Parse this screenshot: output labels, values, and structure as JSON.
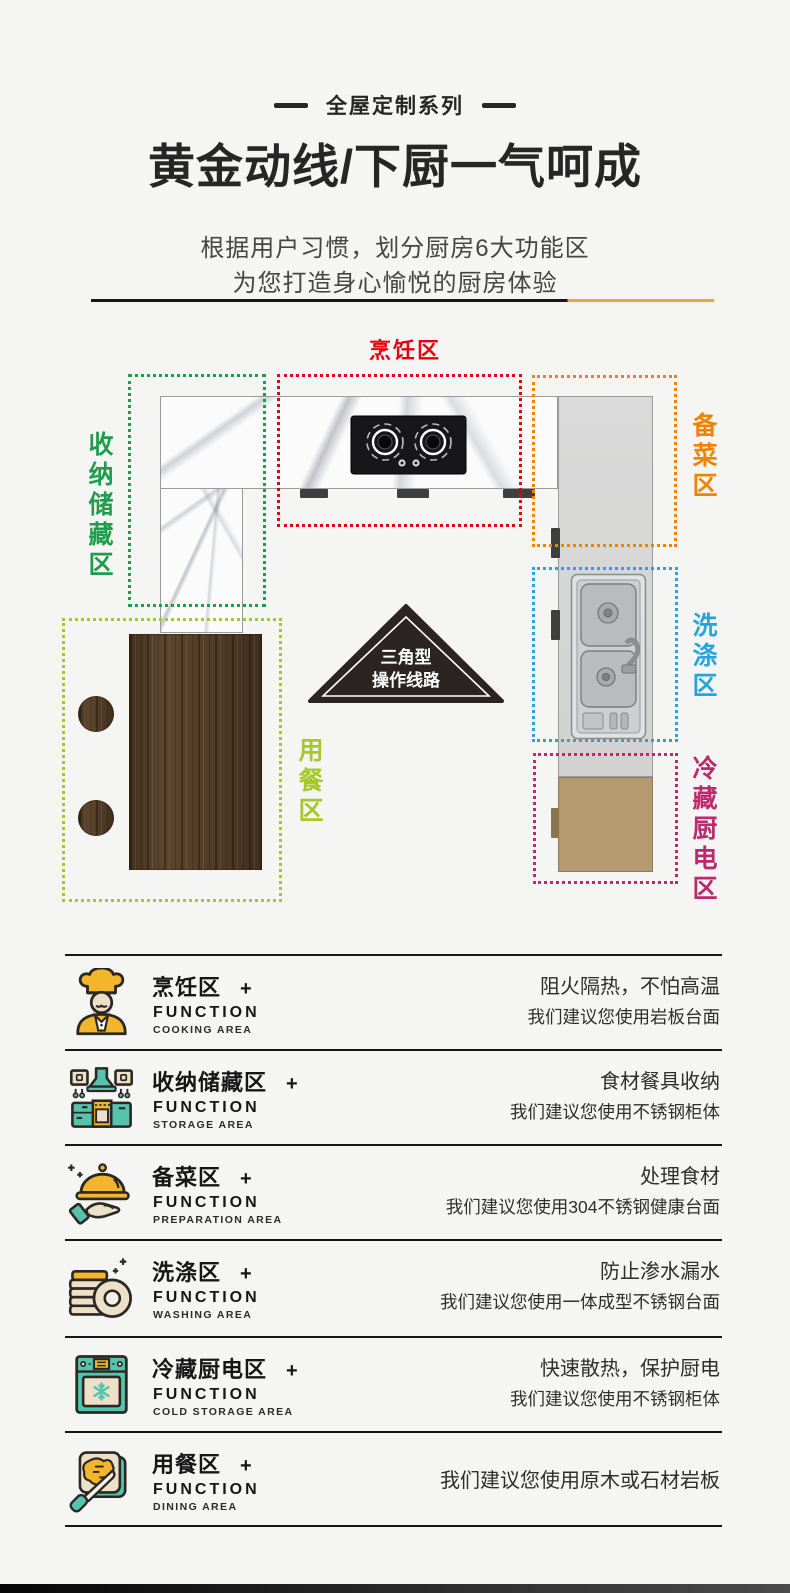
{
  "window": {
    "width": 790,
    "height": 1593,
    "background": "#f5f5f3"
  },
  "header": {
    "series_label": "全屋定制系列",
    "title": "黄金动线/下厨一气呵成",
    "subtitle_line1": "根据用户习惯，划分厨房6大功能区",
    "subtitle_line2": "为您打造身心愉悦的厨房体验"
  },
  "colors": {
    "accent_orange": "#f0a23f",
    "zone_cooking": "#e60012",
    "zone_storage": "#1f9d4d",
    "zone_preparation": "#f08300",
    "zone_washing": "#29a3dd",
    "zone_cold_storage": "#bb2a6c",
    "zone_dining": "#a6c82e",
    "icon_yellow": "#f2b52b",
    "icon_teal": "#56c3ad",
    "icon_cream": "#ece0c8"
  },
  "floor_plan": {
    "zones": [
      {
        "id": "cooking",
        "label": "烹饪区",
        "color": "#e60012"
      },
      {
        "id": "storage",
        "label": "收纳储藏区",
        "color": "#1f9d4d"
      },
      {
        "id": "preparation",
        "label": "备菜区",
        "color": "#f08300"
      },
      {
        "id": "washing",
        "label": "洗涤区",
        "color": "#29a3dd"
      },
      {
        "id": "cold_storage",
        "label": "冷藏厨电区",
        "color": "#bb2a6c"
      },
      {
        "id": "dining",
        "label": "用餐区",
        "color": "#a6c82e"
      }
    ],
    "triangle": {
      "line1": "三角型",
      "line2": "操作线路"
    }
  },
  "functions": [
    {
      "icon": "chef-icon",
      "title": "烹饪区",
      "plus": "+",
      "function_label": "FUNCTION",
      "area_label": "COOKING AREA",
      "desc_line1": "阻火隔热，不怕高温",
      "desc_line2": "我们建议您使用岩板台面"
    },
    {
      "icon": "storage-icon",
      "title": "收纳储藏区",
      "plus": "+",
      "function_label": "FUNCTION",
      "area_label": "STORAGE AREA",
      "desc_line1": "食材餐具收纳",
      "desc_line2": "我们建议您使用不锈钢柜体"
    },
    {
      "icon": "cloche-icon",
      "title": "备菜区",
      "plus": "+",
      "function_label": "FUNCTION",
      "area_label": "PREPARATION AREA",
      "desc_line1": "处理食材",
      "desc_line2": "我们建议您使用304不锈钢健康台面"
    },
    {
      "icon": "plates-icon",
      "title": "洗涤区",
      "plus": "+",
      "function_label": "FUNCTION",
      "area_label": "WASHING AREA",
      "desc_line1": "防止渗水漏水",
      "desc_line2": "我们建议您使用一体成型不锈钢台面"
    },
    {
      "icon": "fridge-icon",
      "title": "冷藏厨电区",
      "plus": "+",
      "function_label": "FUNCTION",
      "area_label": "COLD STORAGE AREA",
      "desc_line1": "快速散热，保护厨电",
      "desc_line2": "我们建议您使用不锈钢柜体"
    },
    {
      "icon": "toast-icon",
      "title": "用餐区",
      "plus": "+",
      "function_label": "FUNCTION",
      "area_label": "DINING AREA",
      "desc_line1": "我们建议您使用原木或石材岩板",
      "desc_line2": ""
    }
  ]
}
